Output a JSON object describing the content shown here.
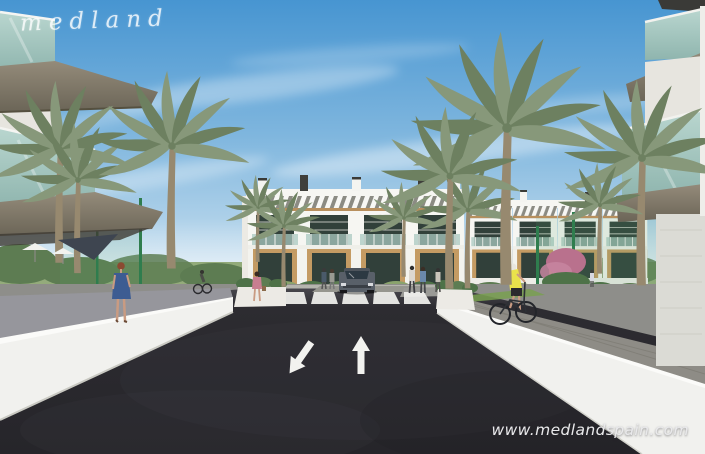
{
  "watermark": {
    "text": "medland"
  },
  "footer": {
    "url": "www.medlandspain.com"
  },
  "colors": {
    "sky_top": "#4795d1",
    "sky_mid": "#7fb6de",
    "sky_horizon": "#d9e9f3",
    "asphalt": "#2d2c31",
    "marking": "#f2f2ef",
    "sidewalk": "#96969c",
    "paver": "#8e8c86",
    "wall_white": "#f1f1ee",
    "wall_bright": "#fbfbf9",
    "building_white": "#f6f6f2",
    "window_dark": "#31403a",
    "wood": "#c49b63",
    "pergola_gap": "#8b8b83",
    "glass_a": "#b9d6cf",
    "glass_b": "#8fb5ae",
    "fascia_a": "#948b7a",
    "fascia_b": "#6b6557",
    "palm": "#87987a",
    "palm_dark": "#6d8060",
    "trunk": "#97896f",
    "foliage": "#5d7c52",
    "foliage_light": "#8aa36d",
    "fence_green": "#2f7d4e",
    "sail": "#3e4550",
    "car_body": "#596069",
    "car_glass": "#2c3943",
    "skin": "#c99b82",
    "hair_auburn": "#8b4a31",
    "dress_blue": "#3d5c92",
    "hivis": "#e9e24b",
    "pink_top": "#c87e90",
    "watermark": "#ffffff",
    "url_text": "#e9e9eb"
  },
  "scene": {
    "type": "architectural-render",
    "road": {
      "arrow_toward_viewer": "down-left",
      "arrow_away_from_viewer": "up",
      "crosswalk_stripe_count": 5
    },
    "vehicles": [
      {
        "name": "car-approaching-crosswalk"
      }
    ],
    "people": [
      {
        "name": "woman-blue-dress-left-sidewalk"
      },
      {
        "name": "cyclist-yellow-vest-right-path"
      },
      {
        "name": "cyclist-distant-left"
      },
      {
        "name": "woman-pink-top-walking"
      },
      {
        "name": "pedestrians-near-crosswalk"
      },
      {
        "name": "pedestrians-right-walkway"
      }
    ],
    "buildings": [
      "central-apartment-block-with-pergolas",
      "glass-balcony-building-top-left",
      "glass-balcony-building-top-right"
    ],
    "landscape": [
      "palm-trees",
      "hedges",
      "green-mesh-fence",
      "shade-sail",
      "white-perimeter-walls"
    ]
  }
}
